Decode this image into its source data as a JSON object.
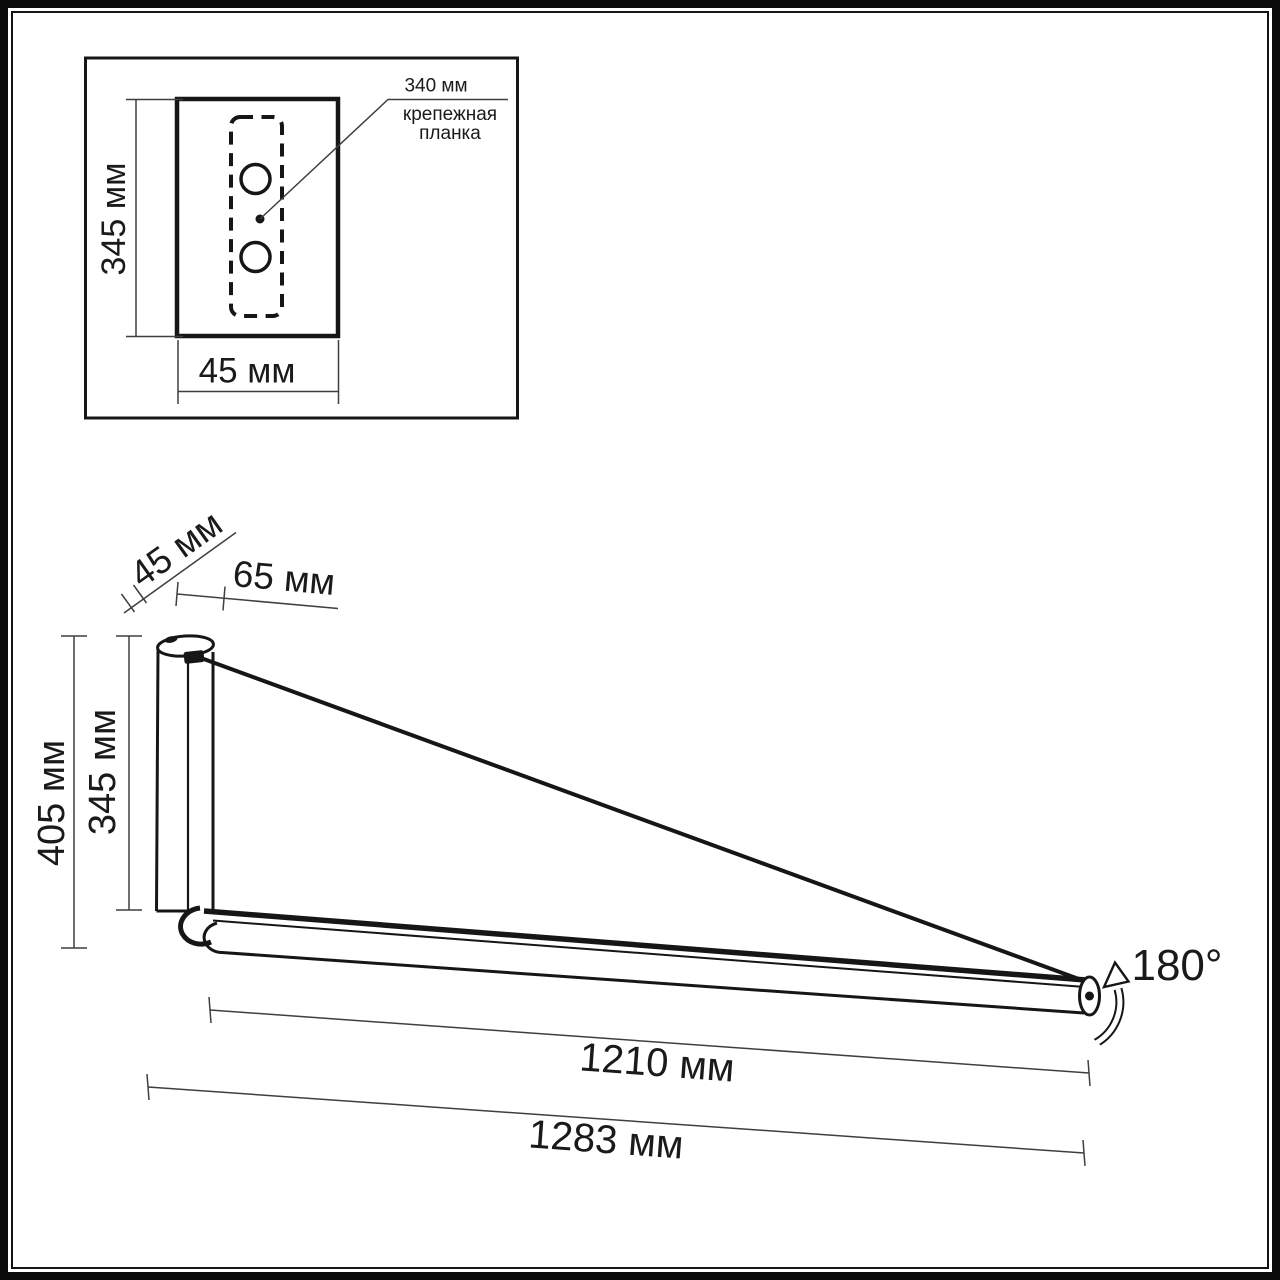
{
  "diagram_title": "Wall light dimensional drawing",
  "inset": {
    "height_dim": "345 мм",
    "width_dim": "45 мм",
    "plate_dim": "340 мм",
    "plate_caption_line1": "крепежная",
    "plate_caption_line2": "планка"
  },
  "main": {
    "bracket_depth_dim": "45 мм",
    "arm_offset_dim": "65 мм",
    "overall_height_dim": "405 мм",
    "bracket_height_dim": "345 мм",
    "arm_length_dim": "1210 мм",
    "overall_length_dim": "1283 мм",
    "rotation_dim": "180°"
  },
  "colors": {
    "drawing_line": "#161616",
    "dimension_line": "#3f3f3f",
    "background": "#ffffff"
  }
}
